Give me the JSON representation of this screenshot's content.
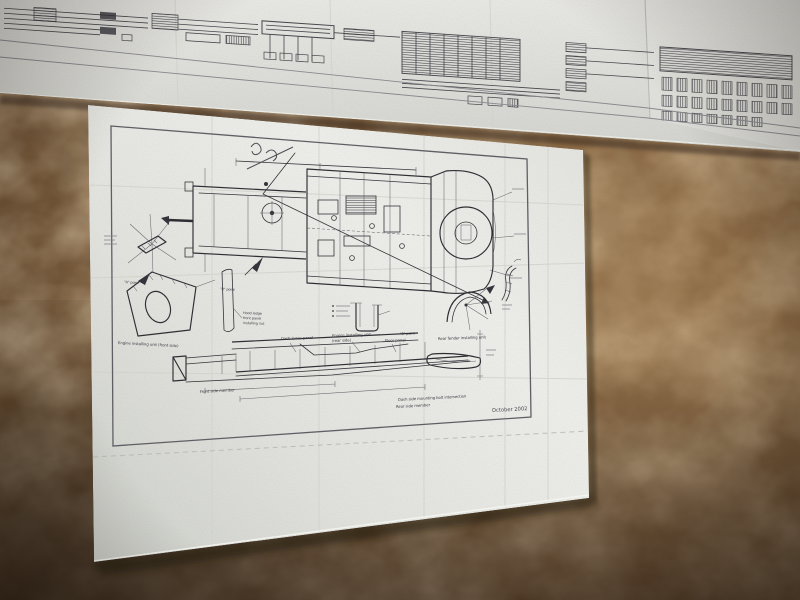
{
  "photo": {
    "description_labels": {
      "date_label": "October 2002"
    },
    "poster": {
      "date_label": "October 2002",
      "labels": {
        "engine_front": "Engine installing unit (front side)",
        "hood_1": "Hood ledge",
        "hood_2": "front panel",
        "hood_3": "installing nut",
        "dash_lower": "Dash lower panel",
        "engine_rear_1": "Engine installing unit",
        "engine_rear_2": "(rear side)",
        "floor_panel": "Floor panel",
        "rear_fender": "Rear fender installing unit",
        "dash_side": "Dash side mounting bolt intersection",
        "rear_side": "Rear side member",
        "front_side": "Front side member",
        "point_a": "\"A\" point",
        "point_b": "\"B\" point",
        "point_c": "\"C\" point"
      }
    },
    "colors": {
      "wall_base": "#745637",
      "wall_light": "#9c7b52",
      "wall_dark": "#4a3520",
      "wall_deep": "#33241a",
      "paper": "#e9eae5",
      "paper_dim": "#d7d8d2",
      "ink": "#35353b",
      "frame_line": "#5f5f65"
    }
  }
}
